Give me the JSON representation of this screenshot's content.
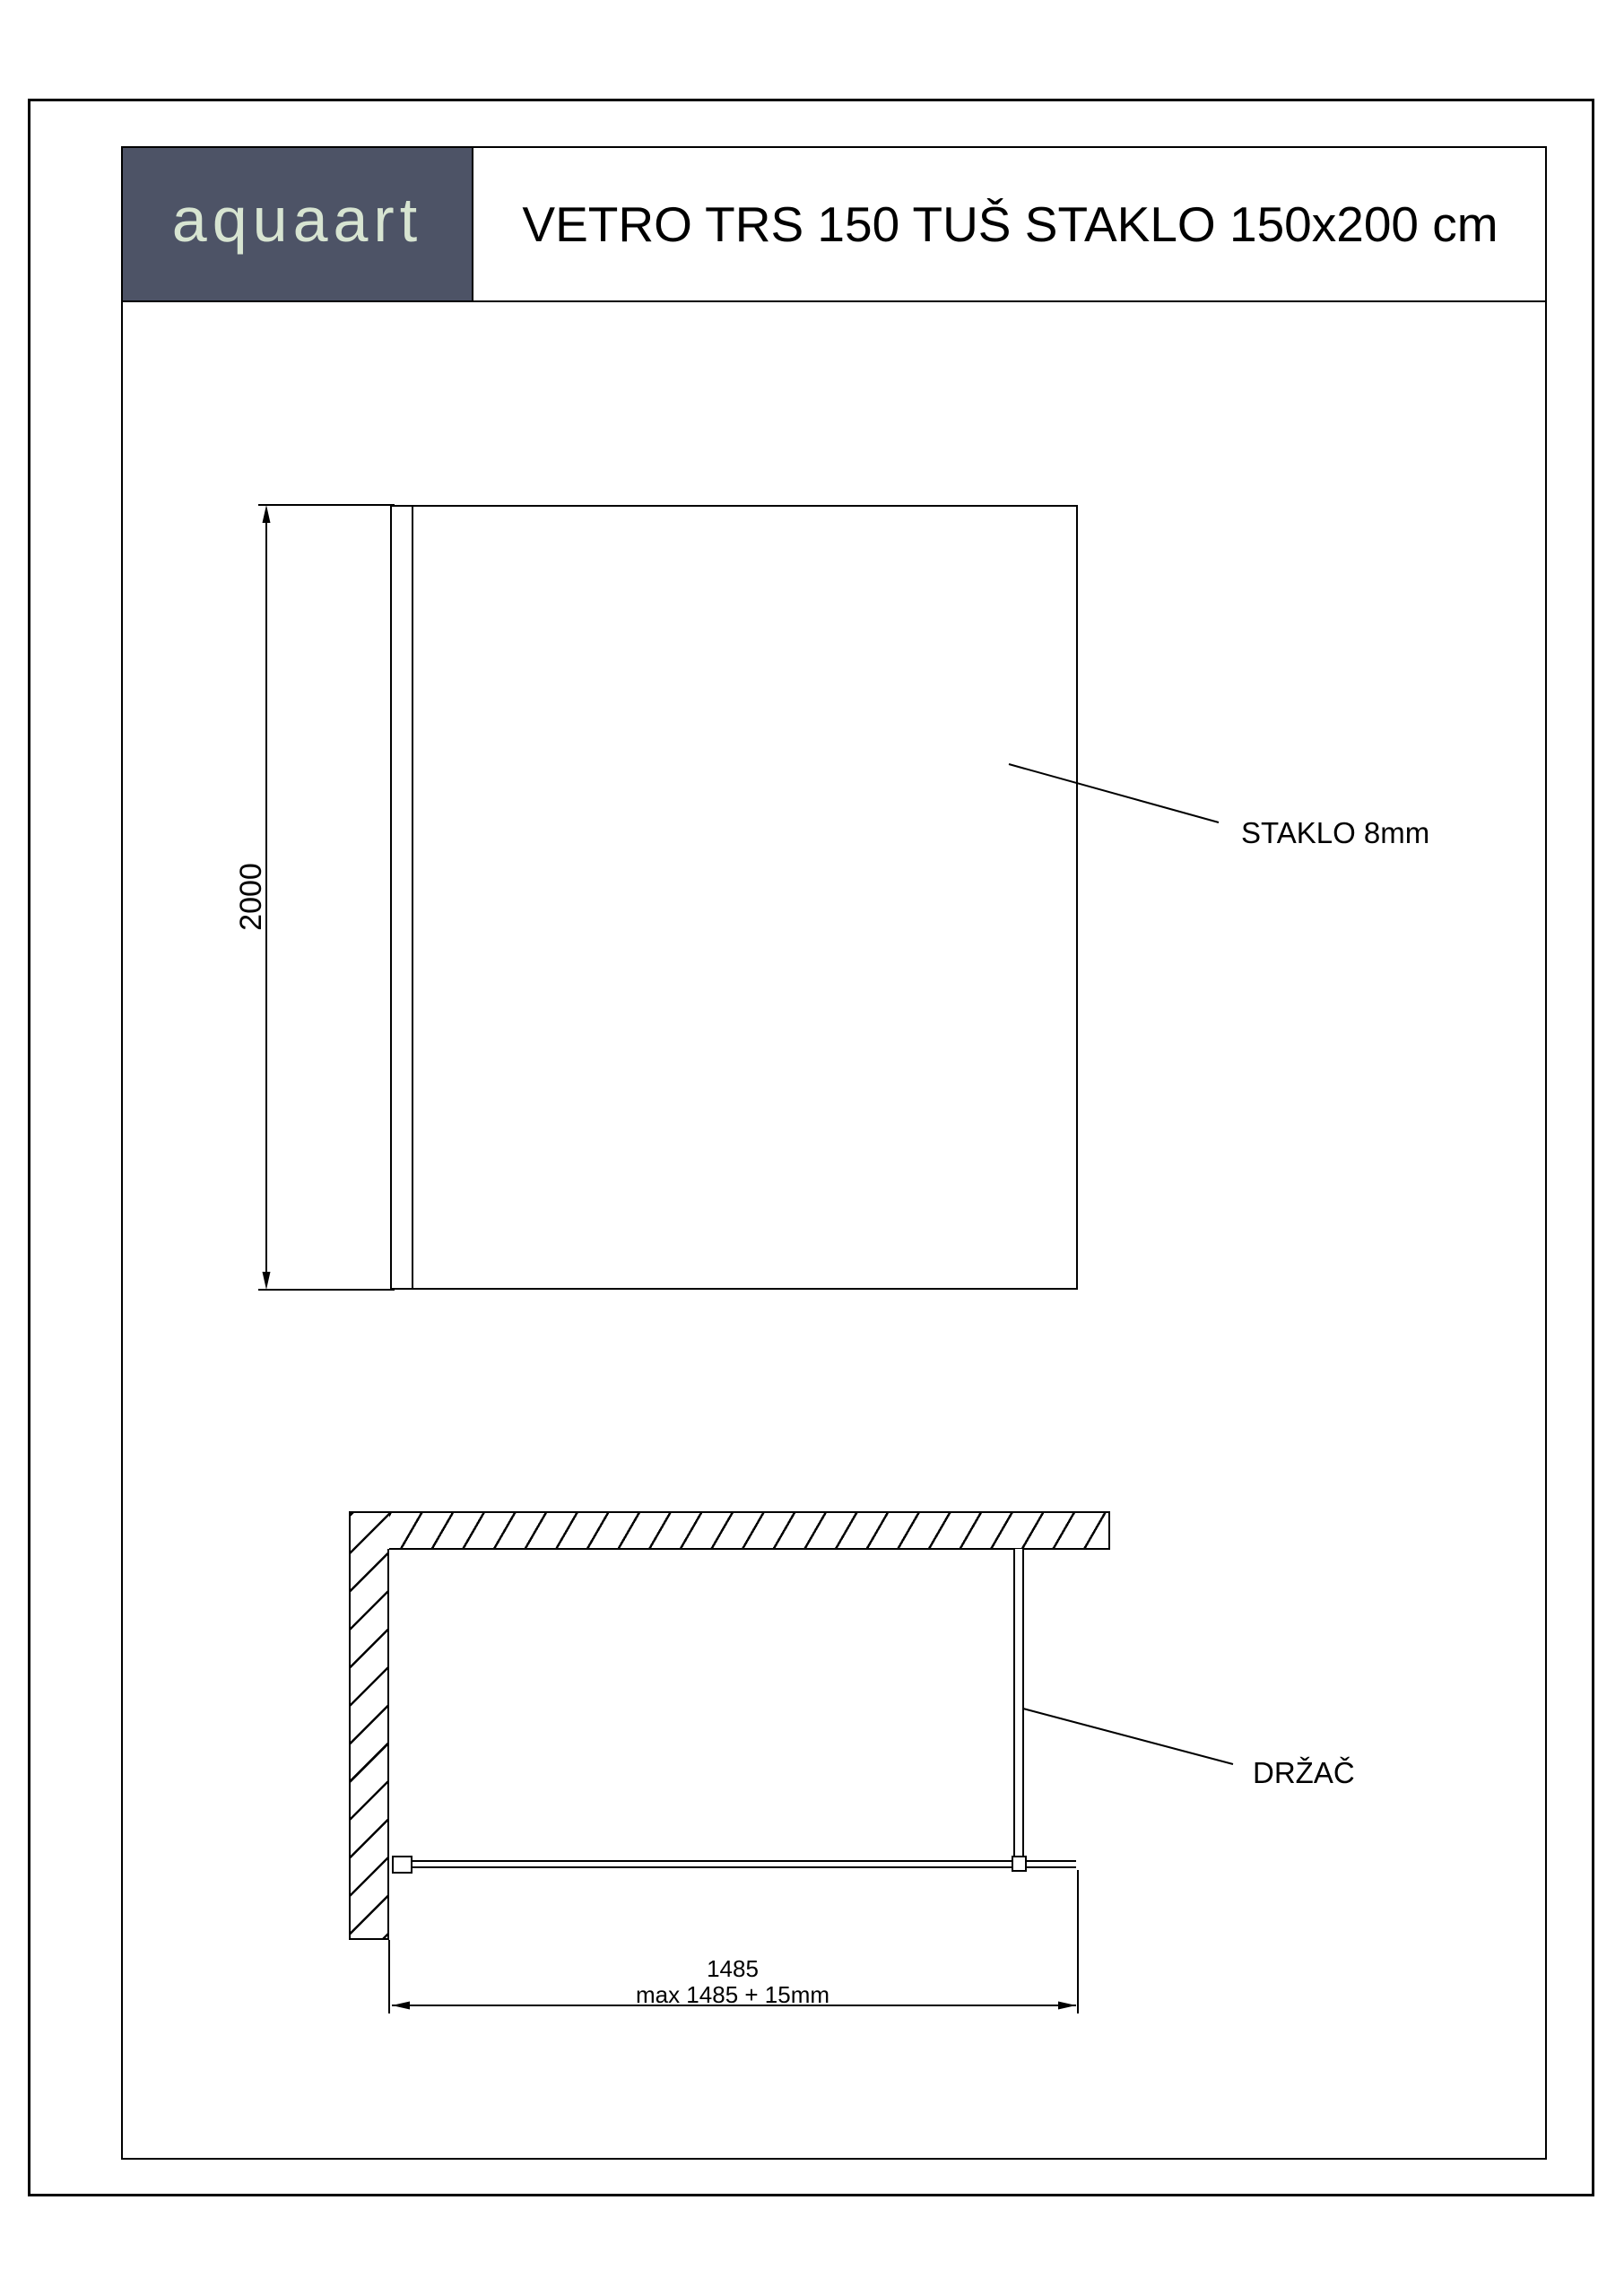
{
  "header": {
    "logo": "aquaart",
    "title": "VETRO TRS 150 TUŠ STAKLO 150x200 cm"
  },
  "front_view": {
    "height_dimension": "2000",
    "glass_callout": "STAKLO 8mm"
  },
  "plan_view": {
    "holder_callout": "DRŽAČ",
    "width_dimension": "1485",
    "width_max_note": "max 1485 + 15mm"
  },
  "colors": {
    "logo-bg": "#4d5366",
    "logo-fg": "#d7e4d1",
    "line": "#000000"
  }
}
